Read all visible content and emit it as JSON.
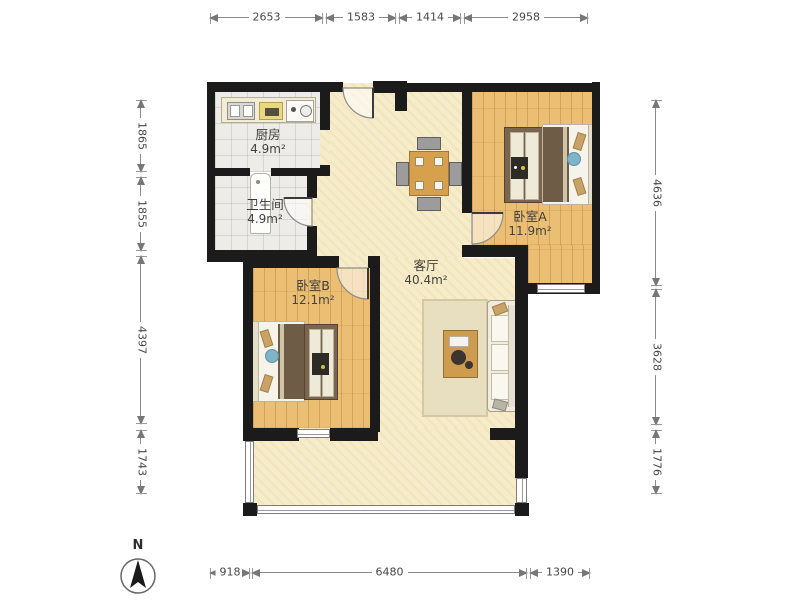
{
  "compass": {
    "label": "N"
  },
  "rooms": {
    "kitchen": {
      "name": "厨房",
      "area": "4.9m²"
    },
    "bathroom": {
      "name": "卫生间",
      "area": "4.9m²"
    },
    "bedroom_a": {
      "name": "卧室A",
      "area": "11.9m²"
    },
    "bedroom_b": {
      "name": "卧室B",
      "area": "12.1m²"
    },
    "living_room": {
      "name": "客厅",
      "area": "40.4m²"
    }
  },
  "dimensions_mm": {
    "top": [
      "2653",
      "1583",
      "1414",
      "2958"
    ],
    "left": [
      "1865",
      "1855",
      "4397",
      "1743"
    ],
    "right": [
      "4636",
      "3628",
      "1776"
    ],
    "bottom": [
      "918",
      "6480",
      "1390"
    ]
  },
  "colors": {
    "wall": "#1b1b1b",
    "living_floor": "#f6ecc9",
    "bedroom_floor": "#eabf74",
    "tile_floor": "#edece8",
    "bed_blanket": "#6f5c46",
    "pillow": "#c8a266",
    "cushion_blue": "#7fb3c8",
    "dimension_text": "#474747"
  }
}
